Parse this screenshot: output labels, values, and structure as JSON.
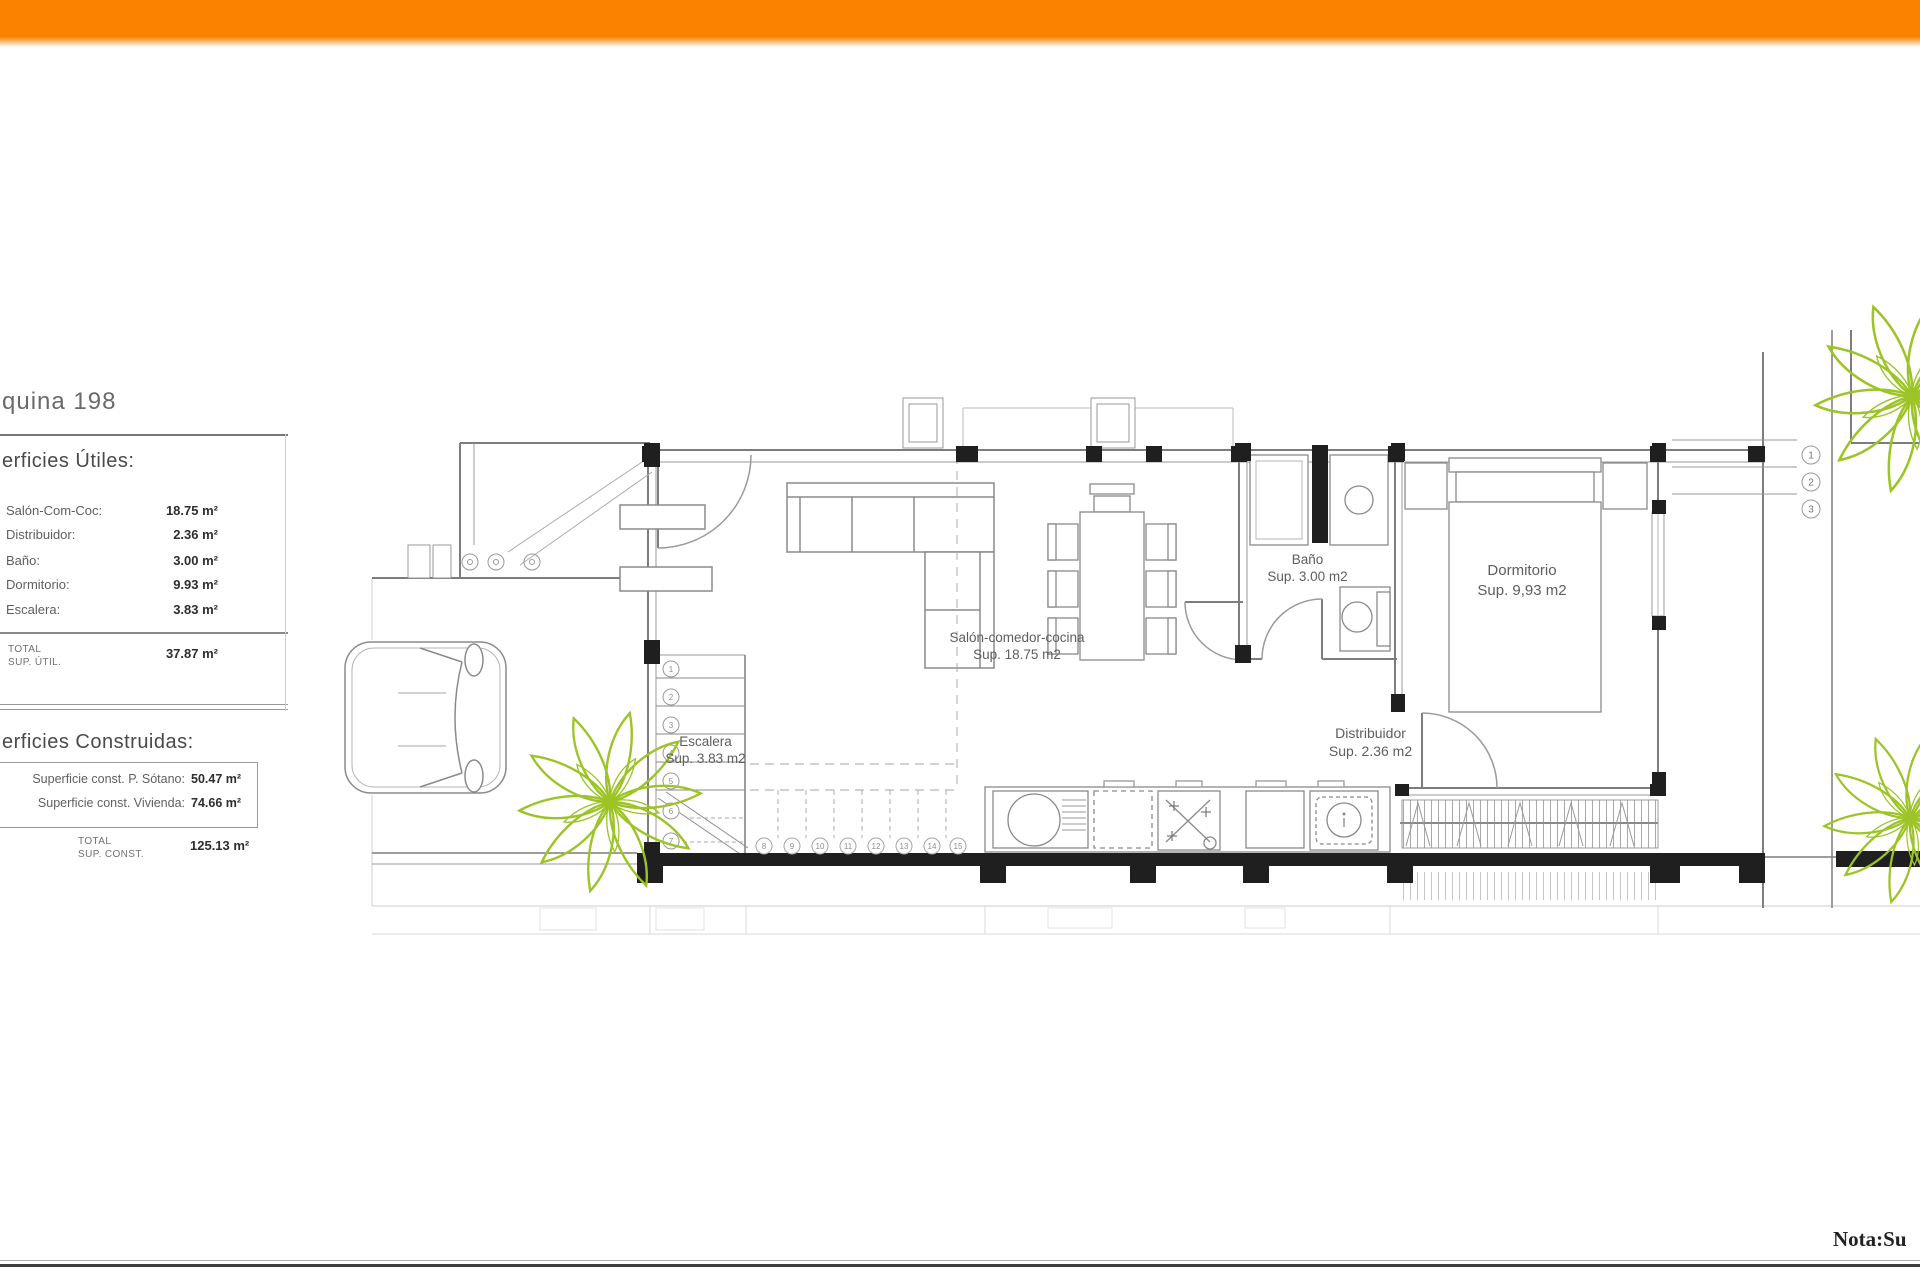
{
  "header": {
    "bar_color": "#FB8200"
  },
  "project": {
    "name_fragment": "quina 198"
  },
  "surfaces_utiles": {
    "heading_fragment": "erficies Útiles:",
    "rows": [
      {
        "label": "Salón-Com-Coc:",
        "value": "18.75 m²"
      },
      {
        "label": "Distribuidor:",
        "value": "2.36 m²"
      },
      {
        "label": "Baño:",
        "value": "3.00 m²"
      },
      {
        "label": "Dormitorio:",
        "value": "9.93 m²"
      },
      {
        "label": "Escalera:",
        "value": "3.83 m²"
      }
    ],
    "total": {
      "line1": "TOTAL",
      "line2": "SUP. ÚTIL.",
      "value": "37.87 m²"
    }
  },
  "surfaces_construidas": {
    "heading_fragment": "erficies Construidas:",
    "rows": [
      {
        "label": "Superficie const. P. Sótano:",
        "value": "50.47 m²"
      },
      {
        "label": "Superficie const. Vivienda:",
        "value": "74.66 m²"
      }
    ],
    "total": {
      "line1": "TOTAL",
      "line2": "SUP. CONST.",
      "value": "125.13 m²"
    }
  },
  "floor_plan": {
    "rooms": [
      {
        "name": "Salón-comedor-cocina",
        "area": "Sup. 18.75 m2"
      },
      {
        "name": "Escalera",
        "area": "Sup. 3.83 m2"
      },
      {
        "name": "Baño",
        "area": "Sup. 3.00 m2"
      },
      {
        "name": "Dormitorio",
        "area": "Sup. 9,93 m2"
      },
      {
        "name": "Distribuidor",
        "area": "Sup. 2.36 m2"
      }
    ],
    "stair_steps": [
      "1",
      "2",
      "3",
      "4",
      "5",
      "6",
      "7"
    ],
    "stair_steps_dashed": [
      "8",
      "9",
      "10",
      "11",
      "12",
      "13",
      "14",
      "15"
    ],
    "level_markers": [
      "1",
      "2",
      "3"
    ]
  },
  "footer": {
    "note_fragment": "Nota:Su"
  }
}
